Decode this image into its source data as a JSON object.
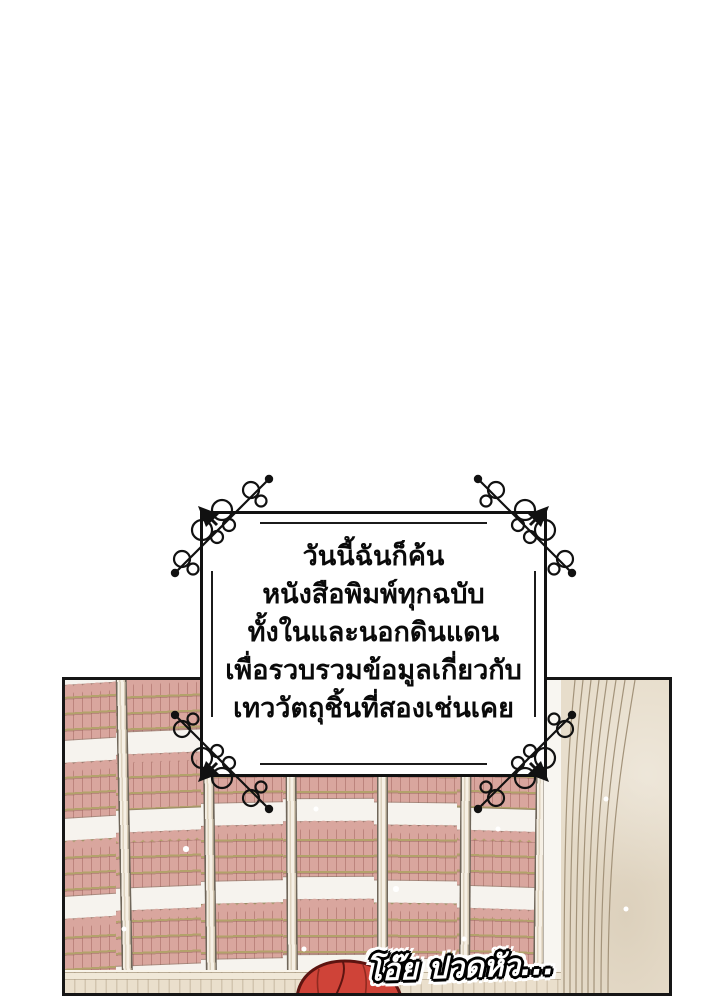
{
  "page": {
    "background": "#ffffff"
  },
  "narration": {
    "lines": [
      "วันนี้ฉันก็ค้น",
      "หนังสือพิมพ์ทุกฉบับ",
      "ทั้งในและนอกดินแดน",
      "เพื่อรวบรวมข้อมูลเกี่ยวกับ",
      "เทววัตถุชิ้นที่สองเช่นเคย"
    ]
  },
  "speech": {
    "text": "โอ๊ย ปวดหัว..."
  },
  "icons": {
    "corner_flourish": "arrow-through-scrollwork",
    "sparkles": "white-dot-sparkles"
  },
  "colors": {
    "panel_border": "#161616",
    "frame_border": "#111111",
    "book_spine": "#d9a69e",
    "book_divider": "#ad736c",
    "book_trim_gold": "#b3a26b",
    "shelf_board": "#f6f3ee",
    "shelf_upright": "#efe7d9",
    "arch_stone": "#e7ddcb",
    "arch_line": "#a3937a",
    "ledge_wood": "#eadfcc",
    "hair_red": "#cf4338",
    "hair_outline": "#5d1410",
    "narration_ink": "#0a0a0a",
    "speech_fill": "#ffffff"
  }
}
